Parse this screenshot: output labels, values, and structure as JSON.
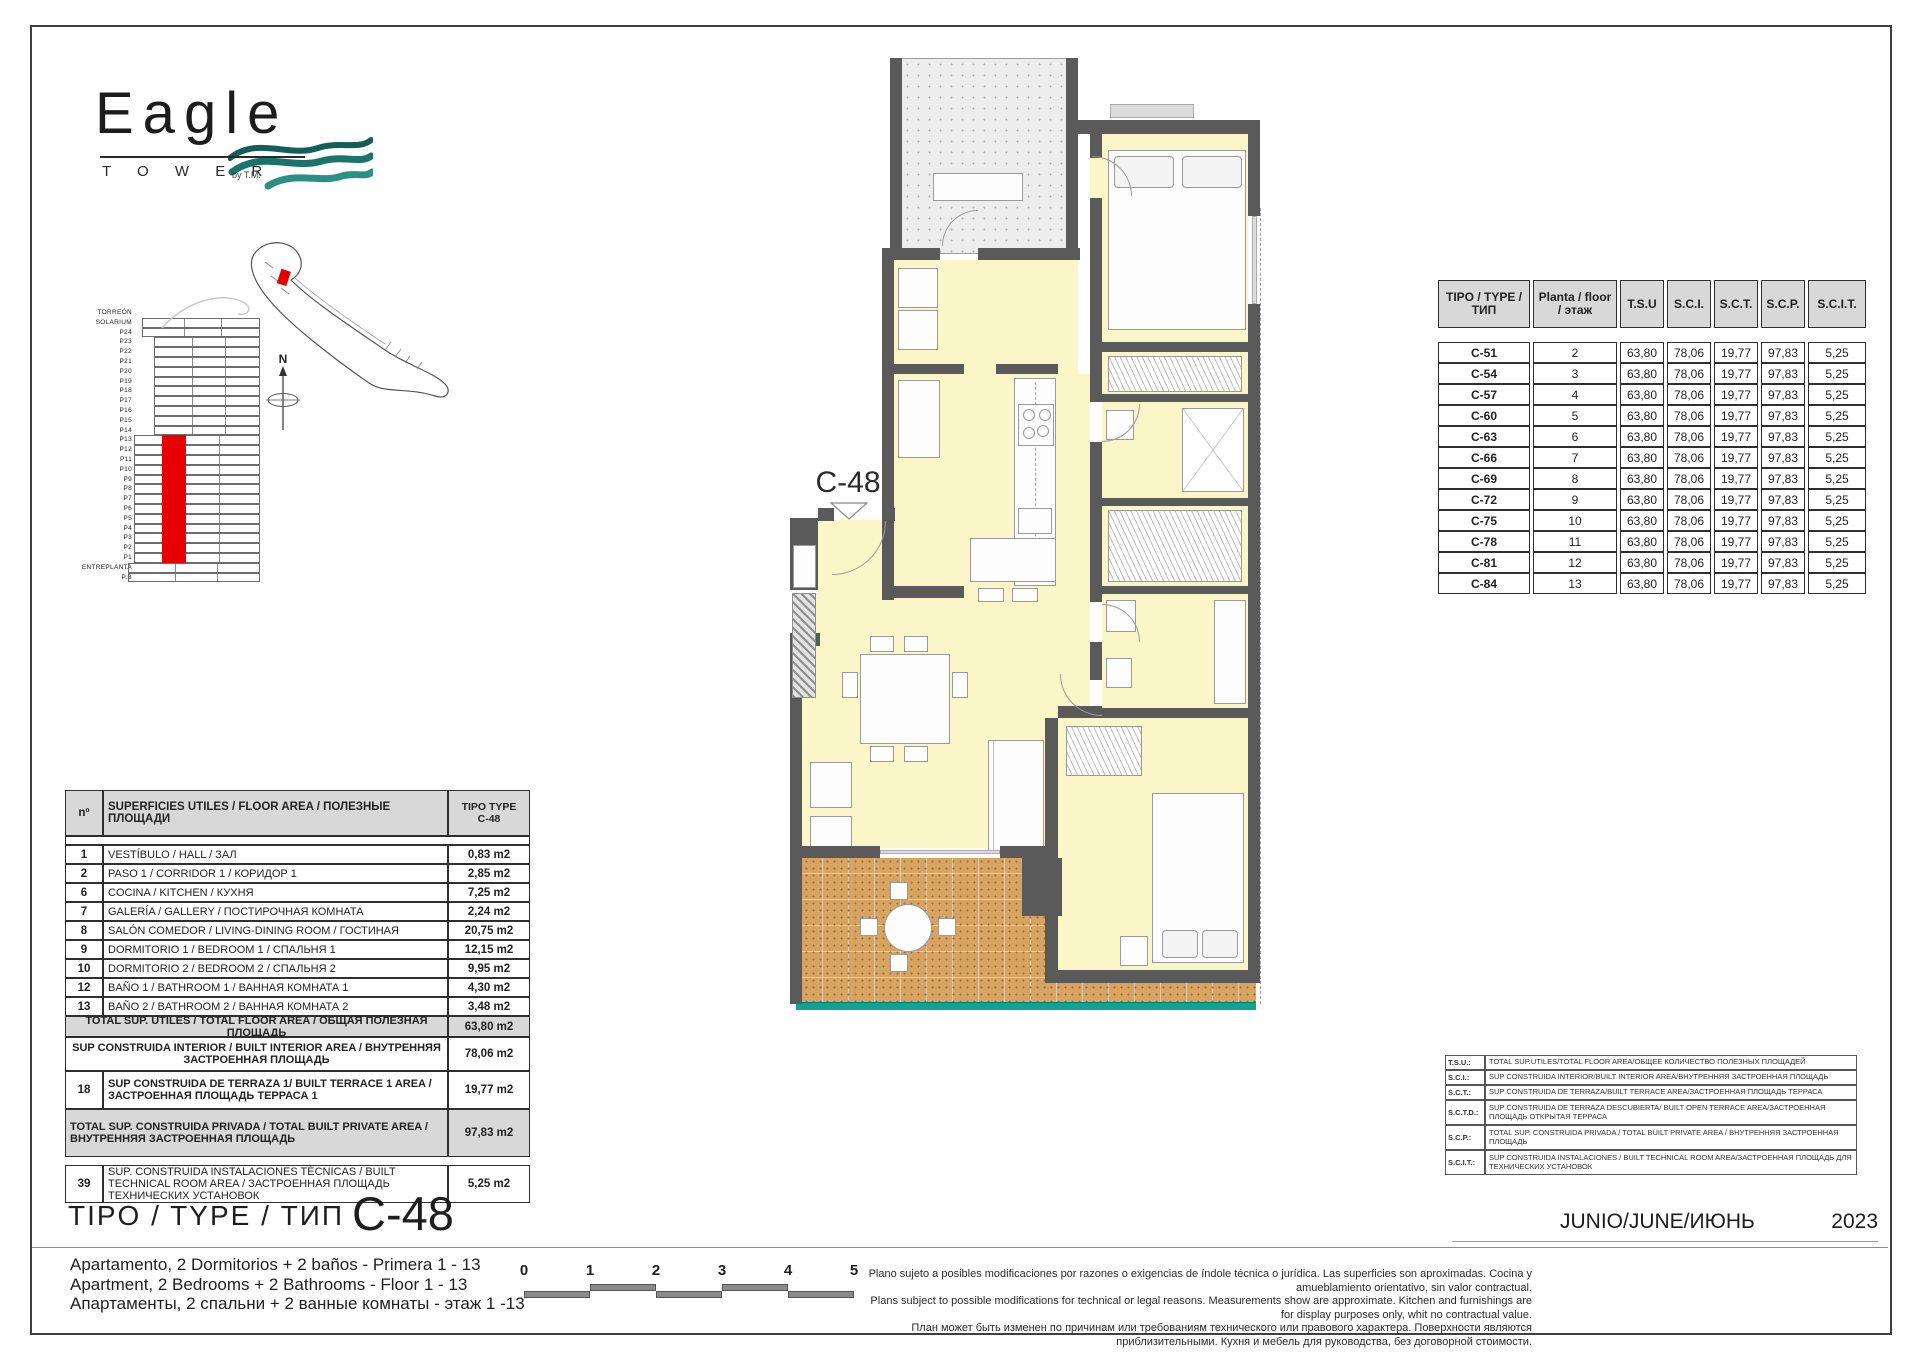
{
  "logo": {
    "wordmark": "Eagle",
    "tower": "T O W E R",
    "by": "by T.M.",
    "wave_colors": [
      "#135f58",
      "#1b746b",
      "#2a9084"
    ]
  },
  "elevation": {
    "floors": [
      "TORREÓN",
      "SOLARIUM",
      "P24",
      "P23",
      "P22",
      "P21",
      "P20",
      "P19",
      "P18",
      "P17",
      "P16",
      "P15",
      "P14",
      "P13",
      "P12",
      "P11",
      "P10",
      "P9",
      "P8",
      "P7",
      "P6",
      "P5",
      "P4",
      "P3",
      "P2",
      "P1",
      "ENTREPLANTA",
      "P.B"
    ],
    "highlight_from": "P13",
    "highlight_to": "P1",
    "highlight_color": "#e60000"
  },
  "compass": {
    "north_label": "N"
  },
  "floor_plan": {
    "unit_label": "C-48",
    "markers": [
      {
        "label": "7"
      },
      {
        "label": "10"
      },
      {
        "label": "6"
      },
      {
        "label": "13"
      },
      {
        "label": "2"
      },
      {
        "label": "1"
      },
      {
        "label": "8"
      },
      {
        "label": "12"
      },
      {
        "label": "9"
      },
      {
        "label": "18"
      }
    ]
  },
  "type_table": {
    "headers": [
      "TIPO / TYPE / ТИП",
      "Planta / floor / этаж",
      "T.S.U",
      "S.C.I.",
      "S.C.T.",
      "S.C.P.",
      "S.C.I.T."
    ],
    "rows": [
      [
        "C-51",
        "2",
        "63,80",
        "78,06",
        "19,77",
        "97,83",
        "5,25"
      ],
      [
        "C-54",
        "3",
        "63,80",
        "78,06",
        "19,77",
        "97,83",
        "5,25"
      ],
      [
        "C-57",
        "4",
        "63,80",
        "78,06",
        "19,77",
        "97,83",
        "5,25"
      ],
      [
        "C-60",
        "5",
        "63,80",
        "78,06",
        "19,77",
        "97,83",
        "5,25"
      ],
      [
        "C-63",
        "6",
        "63,80",
        "78,06",
        "19,77",
        "97,83",
        "5,25"
      ],
      [
        "C-66",
        "7",
        "63,80",
        "78,06",
        "19,77",
        "97,83",
        "5,25"
      ],
      [
        "C-69",
        "8",
        "63,80",
        "78,06",
        "19,77",
        "97,83",
        "5,25"
      ],
      [
        "C-72",
        "9",
        "63,80",
        "78,06",
        "19,77",
        "97,83",
        "5,25"
      ],
      [
        "C-75",
        "10",
        "63,80",
        "78,06",
        "19,77",
        "97,83",
        "5,25"
      ],
      [
        "C-78",
        "11",
        "63,80",
        "78,06",
        "19,77",
        "97,83",
        "5,25"
      ],
      [
        "C-81",
        "12",
        "63,80",
        "78,06",
        "19,77",
        "97,83",
        "5,25"
      ],
      [
        "C-84",
        "13",
        "63,80",
        "78,06",
        "19,77",
        "97,83",
        "5,25"
      ]
    ]
  },
  "area_table": {
    "col_no": "nº",
    "col_label": "SUPERFICIES UTILES / FLOOR AREA / ПОЛЕЗНЫЕ ПЛОЩАДИ",
    "col_type_line1": "TIPO TYPE",
    "col_type_line2": "C-48",
    "rows": [
      {
        "no": "1",
        "label": "VESTÍBULO / HALL / ЗАЛ",
        "value": "0,83 m2"
      },
      {
        "no": "2",
        "label": "PASO 1 /  CORRIDOR 1 / КОРИДОР 1",
        "value": "2,85 m2"
      },
      {
        "no": "6",
        "label": "COCINA / KITCHEN / КУХНЯ",
        "value": "7,25 m2"
      },
      {
        "no": "7",
        "label": "GALERÍA / GALLERY / ПОСТИРОЧНАЯ КОМНАТА",
        "value": "2,24 m2"
      },
      {
        "no": "8",
        "label": "SALÓN COMEDOR  / LIVING-DINING ROOM / ГОСТИНАЯ",
        "value": "20,75 m2"
      },
      {
        "no": "9",
        "label": "DORMITORIO 1 / BEDROOM 1 / СПАЛЬНЯ 1",
        "value": "12,15 m2"
      },
      {
        "no": "10",
        "label": "DORMITORIO 2 / BEDROOM 2 / СПАЛЬНЯ 2",
        "value": "9,95 m2"
      },
      {
        "no": "12",
        "label": "BAÑO 1 / BATHROOM 1 / ВАННАЯ КОМНАТА 1",
        "value": "4,30 m2"
      },
      {
        "no": "13",
        "label": "BAÑO 2 / BATHROOM 2 / ВАННАЯ КОМНАТА 2",
        "value": "3,48 m2"
      }
    ],
    "summary": [
      {
        "no": "",
        "label": "TOTAL SUP. UTILES / TOTAL FLOOR AREA / ОБЩАЯ ПОЛЕЗНАЯ ПЛОЩАДЬ",
        "value": "63,80 m2",
        "shaded": true,
        "full": true,
        "centered": true
      },
      {
        "no": "",
        "label": "SUP CONSTRUIDA INTERIOR / BUILT INTERIOR AREA / ВНУТРЕННЯЯ ЗАСТРОЕННАЯ ПЛОЩАДЬ",
        "value": "78,06 m2",
        "shaded": false,
        "full": true,
        "centered": true
      },
      {
        "no": "18",
        "label": "SUP CONSTRUIDA DE TERRAZA 1/ BUILT TERRACE 1 AREA / ЗАСТРОЕННАЯ ПЛОЩАДЬ ТЕРРАСА  1",
        "value": "19,77 m2",
        "shaded": false,
        "full": false,
        "centered": false
      },
      {
        "no": "",
        "label": "TOTAL SUP. CONSTRUIDA PRIVADA / TOTAL  BUILT PRIVATE AREA / ВНУТРЕННЯЯ ЗАСТРОЕННАЯ ПЛОЩАДЬ",
        "value": "97,83 m2",
        "shaded": true,
        "full": true,
        "centered": false
      }
    ],
    "extra_row": {
      "no": "39",
      "label": "SUP. CONSTRUIDA INSTALACIONES TÉCNICAS / BUILT TECHNICAL ROOM AREA / ЗАСТРОЕННАЯ ПЛОЩАДЬ ТЕХНИЧЕСКИХ УСТАНОВОК",
      "value": "5,25 m2"
    }
  },
  "type_title": {
    "label": "TIPO / TYPE / ТИП",
    "code": "C-48"
  },
  "legend_table": {
    "rows": [
      {
        "abbr": "T.S.U.:",
        "desc": "TOTAL SUP.UTILES/TOTAL FLOOR AREA/ОБЩЕЕ КОЛИЧЕСТВО ПОЛЕЗНЫХ ПЛОЩАДЕЙ"
      },
      {
        "abbr": "S.C.I.:",
        "desc": "SUP CONSTRUIDA INTERIOR/BUILT INTERIOR AREA/ВНУТРЕННЯЯ ЗАСТРОЕННАЯ ПЛОЩАДЬ"
      },
      {
        "abbr": "S.C.T.:",
        "desc": "SUP CONSTRUIDA DE TERRAZA/BUILT TERRACE AREA/ЗАСТРОЕННАЯ ПЛОЩАДЬ ТЕРРАСА"
      },
      {
        "abbr": "S.C.T.D.:",
        "desc": "SUP CONSTRUIDA DE TERRAZA DESCUBIERTA/ BUILT OPEN TERRACE AREA/ЗАСТРОЕННАЯ ПЛОЩАДЬ ОТКРЫТАЯ ТЕРРАСА"
      },
      {
        "abbr": "S.C.P.:",
        "desc": "TOTAL SUP. CONSTRUIDA PRIVADA / TOTAL  BUILT PRIVATE AREA / ВНУТРЕННЯЯ ЗАСТРОЕННАЯ ПЛОЩАДЬ"
      },
      {
        "abbr": "S.C.I.T.:",
        "desc": "SUP CONSTRUIDA INSTALACIONES / BUILT TECHNICAL ROOM AREA/ЗАСТРОЕННАЯ ПЛОЩАДЬ ДЛЯ ТЕХНИЧЕСКИХ УСТАНОВОК"
      }
    ]
  },
  "date": {
    "months": "JUNIO/JUNE/ИЮНЬ",
    "year": "2023"
  },
  "footer": {
    "description": [
      "Apartamento, 2 Dormitorios + 2 baños - Primera 1 - 13",
      "Apartment, 2 Bedrooms + 2 Bathrooms - Floor 1 - 13",
      "Апартаменты, 2 спальни + 2 ванные комнаты - этаж 1 -13"
    ],
    "scale_numbers": [
      "0",
      "1",
      "2",
      "3",
      "4",
      "5"
    ],
    "disclaimer": [
      "Plano sujeto a posibles modificaciones por razones o exigencias de índole técnica o jurídica. Las superficies son aproximadas. Cocina y amueblamiento orientativo, sin valor contractual.",
      "Plans subject to possible modifications for technical or legal reasons. Measurements show are approximate. Kitchen and furnishings are for display purposes only, whit no contractual value.",
      "План может быть изменен по причинам или требованиям технического или правового характера. Поверхности являются приблизительными. Кухня и мебель для руководства, без договорной стоимости."
    ]
  },
  "colors": {
    "highlight_red": "#e60000",
    "wall_grey": "#5a5a5a",
    "room_yellow": "#faf6c8",
    "terrace_tan": "#d7a360",
    "teal_accent": "#0fa396",
    "table_shade": "#d8d8d8"
  }
}
